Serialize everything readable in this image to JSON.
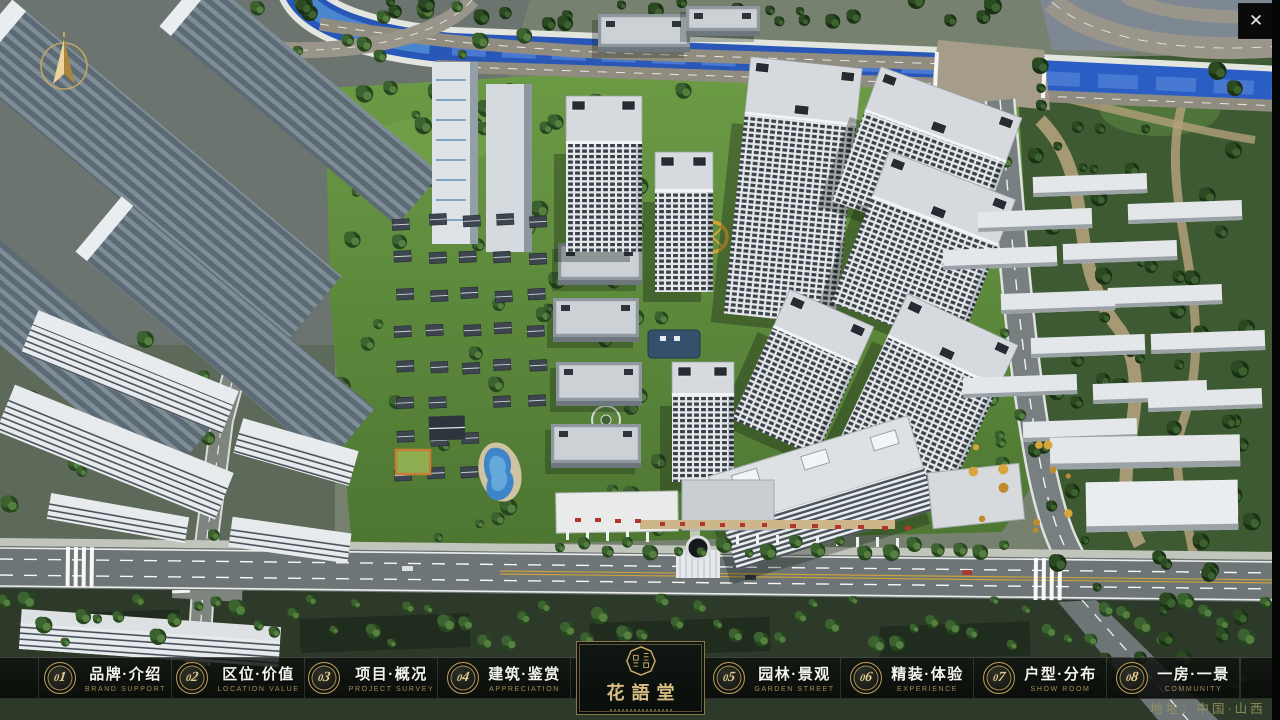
{
  "window": {
    "close_label": "✕"
  },
  "nav": {
    "items": [
      {
        "num": "01",
        "zh": "品牌·介绍",
        "en": "BRAND SUPPORT"
      },
      {
        "num": "02",
        "zh": "区位·价值",
        "en": "LOCATION VALUE"
      },
      {
        "num": "03",
        "zh": "项目·概况",
        "en": "PROJECT SURVEY"
      },
      {
        "num": "04",
        "zh": "建筑·鉴赏",
        "en": "APPRECIATION"
      },
      {
        "num": "05",
        "zh": "园林·景观",
        "en": "GARDEN STREET"
      },
      {
        "num": "06",
        "zh": "精装·体验",
        "en": "EXPERIENCE"
      },
      {
        "num": "07",
        "zh": "户型·分布",
        "en": "SHOW ROOM"
      },
      {
        "num": "08",
        "zh": "一房·一景",
        "en": "COMMUNITY"
      }
    ]
  },
  "logo": {
    "title": "花語堂"
  },
  "footer": {
    "address": "地址：中国·山西"
  },
  "colors": {
    "accent_gold": "#bb9d5f",
    "water_blue": "#2857b8",
    "nav_bg": "#0b0e0b"
  }
}
